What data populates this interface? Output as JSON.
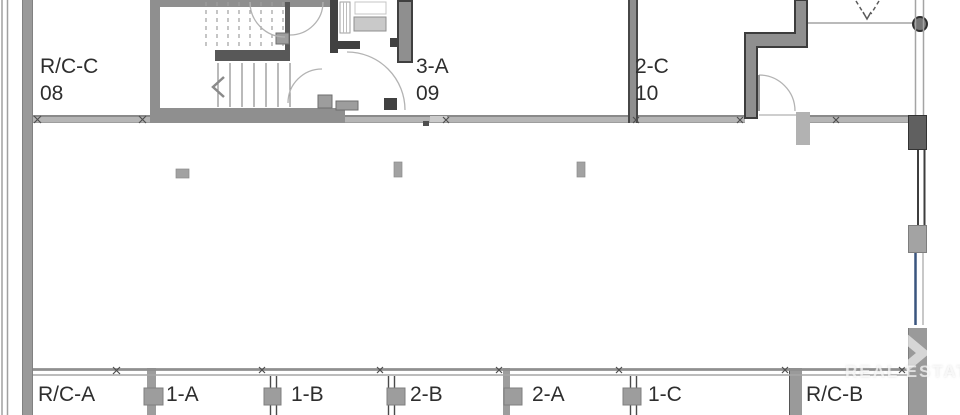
{
  "plan": {
    "top_units": [
      {
        "label": "R/C-C",
        "number": "08"
      },
      {
        "label": "3-A",
        "number": "09"
      },
      {
        "label": "2-C",
        "number": "10"
      }
    ],
    "bottom_units": [
      {
        "label": "R/C-A"
      },
      {
        "label": "1-A"
      },
      {
        "label": "1-B"
      },
      {
        "label": "2-B"
      },
      {
        "label": "2-A"
      },
      {
        "label": "1-C"
      },
      {
        "label": "R/C-B"
      }
    ],
    "watermark": {
      "text": "REAL ESTATE"
    }
  },
  "colors": {
    "wall_grey": "#8f8f8f",
    "wall_light_grey": "#b5b5b5",
    "wall_dark": "#414141",
    "glazing_blue": "#3a557f",
    "label_text": "#2e2e2e",
    "background": "#ffffff"
  }
}
